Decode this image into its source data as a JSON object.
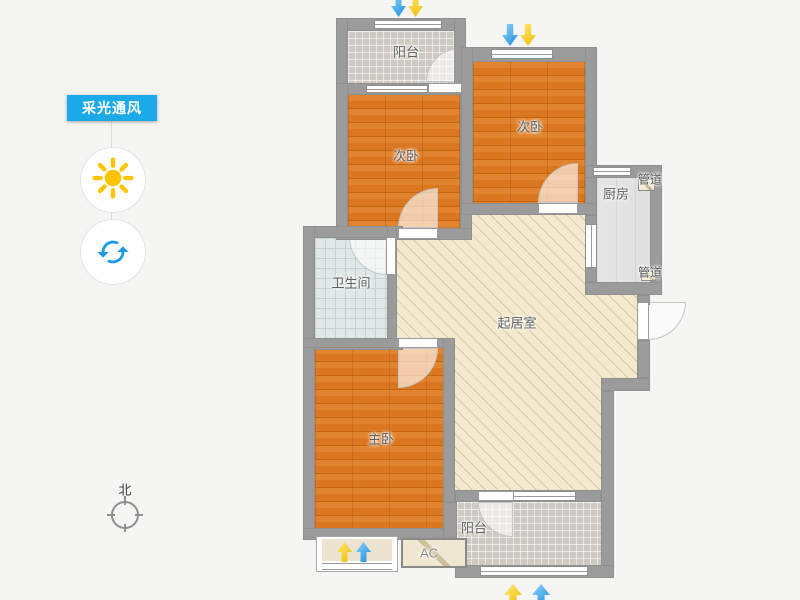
{
  "app": {
    "background": "#f5f5f4"
  },
  "controls": {
    "panel_label": "采光通风",
    "daylight_button_icon": "sun-icon",
    "ventilation_button_icon": "refresh-icon"
  },
  "compass": {
    "label": "北"
  },
  "floorplan": {
    "rooms": {
      "balcony_top": "阳台",
      "bedroom_top_left": "次卧",
      "bedroom_top_right": "次卧",
      "kitchen": "厨房",
      "duct_top": "管道",
      "duct_bottom": "管道",
      "bathroom": "卫生间",
      "living_room": "起居室",
      "master_bedroom": "主卧",
      "balcony_bottom": "阳台",
      "ac_platform": "AC"
    },
    "colors": {
      "wall": "#9b9b9b",
      "wood_floor": "#dd7b26",
      "living_floor": "#f3e9cd",
      "tile_floor": "#d6d1ca",
      "bath_floor": "#e2e8e7",
      "kitchen_floor": "#e2e2e2",
      "accent_blue": "#1ba9e8",
      "arrow_blue": "#1b8fdb",
      "arrow_yellow": "#eebc00"
    }
  }
}
